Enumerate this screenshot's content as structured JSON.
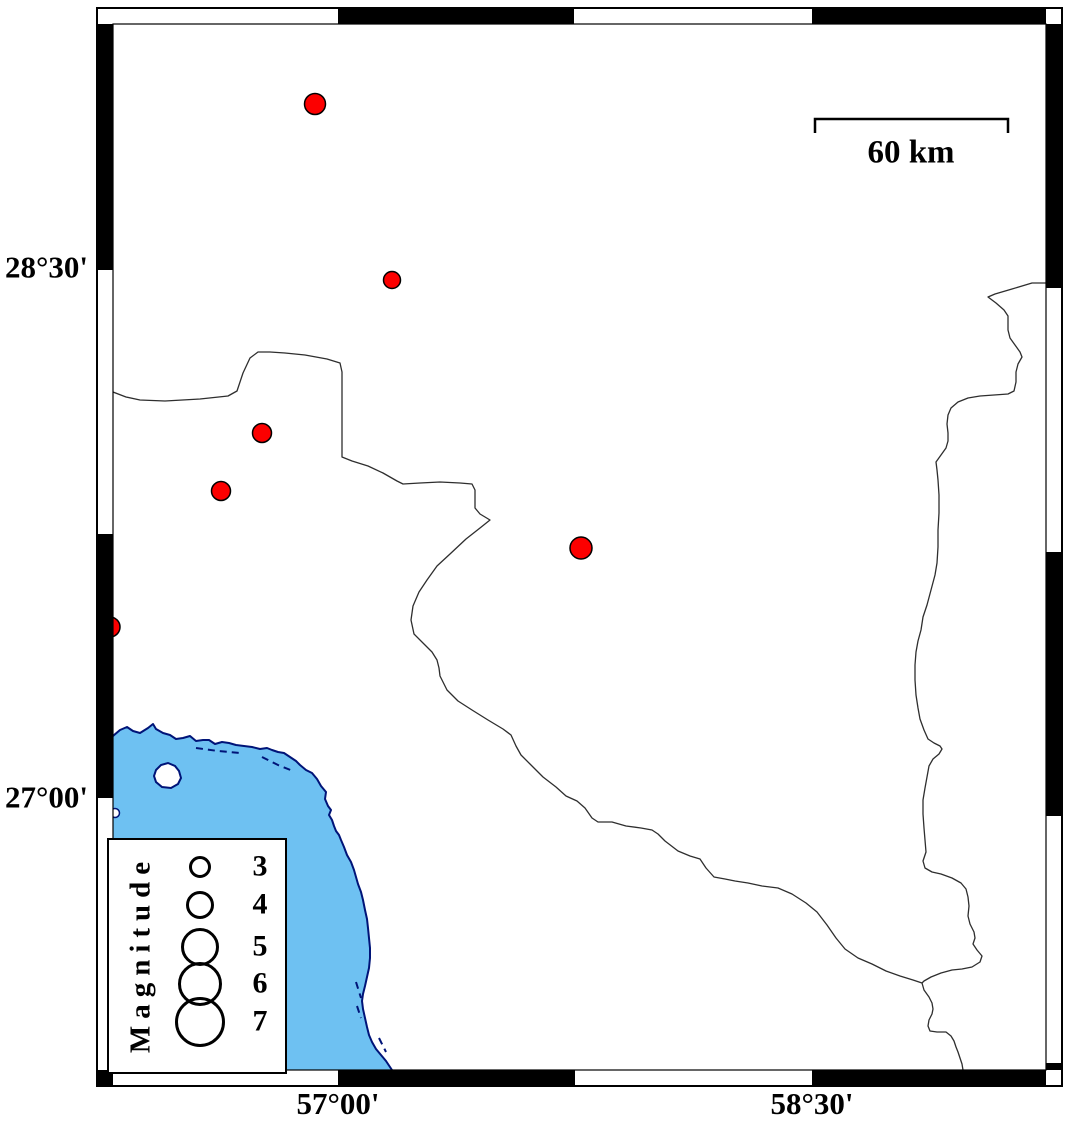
{
  "figure": {
    "width": 1066,
    "height": 1122,
    "background": "#ffffff"
  },
  "colors": {
    "sea": "#6ec1f2",
    "coast": "#001478",
    "epicenter_fill": "#fc0000",
    "epicenter_stroke": "#000000",
    "admin_border": "#2e2e2e",
    "frame_black": "#000000",
    "frame_white": "#ffffff",
    "text": "#000000"
  },
  "axis_labels": {
    "left": [
      {
        "text": "28°30'",
        "y": 268
      },
      {
        "text": "27°00'",
        "y": 798
      }
    ],
    "bottom": [
      {
        "text": "57°00'",
        "x": 338
      },
      {
        "text": "58°30'",
        "x": 812
      }
    ]
  },
  "scale_bar": {
    "label": "60 km",
    "x1": 815,
    "x2": 1008,
    "y": 119,
    "tick_drop": 14
  },
  "legend": {
    "title": "Magnitude",
    "box": {
      "x": 107,
      "y": 838,
      "width": 180,
      "height": 236
    },
    "circle_cx": 198,
    "label_x": 258,
    "entries": [
      {
        "label": "3",
        "cy": 865,
        "r": 11
      },
      {
        "label": "4",
        "cy": 903,
        "r": 14
      },
      {
        "label": "5",
        "cy": 945,
        "r": 19
      },
      {
        "label": "6",
        "cy": 982,
        "r": 22
      },
      {
        "label": "7",
        "cy": 1020,
        "r": 25
      }
    ]
  },
  "earthquakes": [
    {
      "x": 315,
      "y": 104,
      "r": 10.5
    },
    {
      "x": 392,
      "y": 280,
      "r": 8.5
    },
    {
      "x": 262,
      "y": 433,
      "r": 9.5
    },
    {
      "x": 221,
      "y": 491,
      "r": 9.5
    },
    {
      "x": 581,
      "y": 548,
      "r": 11
    },
    {
      "x": 110,
      "y": 627,
      "r": 10
    }
  ],
  "frame": {
    "outer": {
      "x": 97,
      "y": 8,
      "w": 965,
      "h": 1078
    },
    "inner": {
      "x": 113,
      "y": 24,
      "w": 933,
      "h": 1046
    },
    "top_segments": [
      {
        "from": 113,
        "to": 338,
        "color": "white"
      },
      {
        "from": 338,
        "to": 574,
        "color": "black"
      },
      {
        "from": 574,
        "to": 812,
        "color": "white"
      },
      {
        "from": 812,
        "to": 1046,
        "color": "black"
      }
    ],
    "bottom_segments": [
      {
        "from": 113,
        "to": 338,
        "color": "white"
      },
      {
        "from": 338,
        "to": 575,
        "color": "black"
      },
      {
        "from": 575,
        "to": 812,
        "color": "white"
      },
      {
        "from": 812,
        "to": 1046,
        "color": "black"
      }
    ],
    "left_segments": [
      {
        "from": 24,
        "to": 270,
        "color": "black"
      },
      {
        "from": 270,
        "to": 534,
        "color": "white"
      },
      {
        "from": 534,
        "to": 798,
        "color": "black"
      },
      {
        "from": 798,
        "to": 1070,
        "color": "white"
      }
    ],
    "right_segments": [
      {
        "from": 24,
        "to": 288,
        "color": "black"
      },
      {
        "from": 288,
        "to": 552,
        "color": "white"
      },
      {
        "from": 552,
        "to": 816,
        "color": "black"
      },
      {
        "from": 816,
        "to": 1063,
        "color": "white"
      },
      {
        "from": 1063,
        "to": 1070,
        "color": "black"
      }
    ],
    "corners": {
      "tl": "white",
      "tr": "white",
      "bl": "black",
      "br": "white"
    }
  },
  "geography": {
    "coastline": [
      [
        113,
        736
      ],
      [
        120,
        730
      ],
      [
        127,
        727
      ],
      [
        133,
        731
      ],
      [
        140,
        733
      ],
      [
        148,
        728
      ],
      [
        153,
        724
      ],
      [
        156,
        729
      ],
      [
        163,
        733
      ],
      [
        170,
        735
      ],
      [
        176,
        739
      ],
      [
        183,
        738
      ],
      [
        190,
        736
      ],
      [
        196,
        741
      ],
      [
        203,
        740
      ],
      [
        209,
        740
      ],
      [
        215,
        744
      ],
      [
        222,
        742
      ],
      [
        229,
        743
      ],
      [
        236,
        745
      ],
      [
        244,
        746
      ],
      [
        252,
        747
      ],
      [
        260,
        749
      ],
      [
        267,
        748
      ],
      [
        272,
        750
      ],
      [
        278,
        752
      ],
      [
        284,
        753
      ],
      [
        290,
        757
      ],
      [
        296,
        761
      ],
      [
        300,
        765
      ],
      [
        306,
        770
      ],
      [
        312,
        773
      ],
      [
        317,
        779
      ],
      [
        321,
        786
      ],
      [
        326,
        792
      ],
      [
        325,
        799
      ],
      [
        328,
        806
      ],
      [
        331,
        810
      ],
      [
        329,
        815
      ],
      [
        332,
        820
      ],
      [
        334,
        826
      ],
      [
        336,
        831
      ],
      [
        339,
        835
      ],
      [
        341,
        840
      ],
      [
        344,
        847
      ],
      [
        347,
        855
      ],
      [
        351,
        862
      ],
      [
        354,
        870
      ],
      [
        356,
        877
      ],
      [
        358,
        884
      ],
      [
        361,
        892
      ],
      [
        363,
        900
      ],
      [
        365,
        910
      ],
      [
        367,
        919
      ],
      [
        368,
        928
      ],
      [
        369,
        938
      ],
      [
        370,
        948
      ],
      [
        370,
        958
      ],
      [
        369,
        968
      ],
      [
        367,
        977
      ],
      [
        365,
        986
      ],
      [
        363,
        994
      ],
      [
        362,
        1001
      ],
      [
        363,
        1009
      ],
      [
        365,
        1018
      ],
      [
        367,
        1027
      ],
      [
        369,
        1035
      ],
      [
        372,
        1042
      ],
      [
        376,
        1049
      ],
      [
        381,
        1055
      ],
      [
        386,
        1061
      ],
      [
        390,
        1067
      ],
      [
        392,
        1070
      ]
    ],
    "sea_close": [
      [
        392,
        1070
      ],
      [
        113,
        1070
      ]
    ],
    "island": [
      [
        156,
        770
      ],
      [
        161,
        765
      ],
      [
        168,
        763
      ],
      [
        175,
        766
      ],
      [
        179,
        771
      ],
      [
        181,
        778
      ],
      [
        178,
        784
      ],
      [
        171,
        788
      ],
      [
        162,
        787
      ],
      [
        156,
        782
      ],
      [
        154,
        776
      ]
    ],
    "islet": {
      "cx": 115,
      "cy": 813,
      "r": 4.5
    },
    "shoal_dashes": [
      [
        [
          196,
          748
        ],
        [
          218,
          751
        ],
        [
          240,
          753
        ]
      ],
      [
        [
          262,
          757
        ],
        [
          278,
          765
        ],
        [
          293,
          771
        ]
      ],
      [
        [
          356,
          982
        ],
        [
          361,
          998
        ]
      ],
      [
        [
          357,
          1006
        ],
        [
          361,
          1018
        ]
      ],
      [
        [
          379,
          1038
        ],
        [
          386,
          1052
        ]
      ]
    ],
    "admin_borders": [
      [
        [
          113,
          392
        ],
        [
          126,
          397
        ],
        [
          140,
          400
        ],
        [
          165,
          401
        ],
        [
          200,
          399
        ],
        [
          228,
          396
        ],
        [
          237,
          391
        ],
        [
          243,
          373
        ],
        [
          250,
          358
        ],
        [
          258,
          352
        ],
        [
          270,
          352
        ],
        [
          285,
          353
        ],
        [
          305,
          355
        ],
        [
          327,
          359
        ],
        [
          340,
          363
        ],
        [
          342,
          372
        ],
        [
          342,
          457
        ],
        [
          352,
          461
        ],
        [
          368,
          466
        ],
        [
          383,
          473
        ],
        [
          397,
          481
        ],
        [
          403,
          484
        ],
        [
          420,
          483
        ],
        [
          440,
          482
        ],
        [
          460,
          483
        ],
        [
          472,
          484
        ],
        [
          475,
          490
        ],
        [
          475,
          508
        ],
        [
          480,
          514
        ],
        [
          490,
          520
        ],
        [
          480,
          528
        ],
        [
          466,
          539
        ],
        [
          450,
          554
        ],
        [
          437,
          566
        ],
        [
          427,
          580
        ],
        [
          419,
          592
        ],
        [
          413,
          606
        ],
        [
          411,
          620
        ],
        [
          414,
          634
        ],
        [
          425,
          645
        ],
        [
          432,
          652
        ],
        [
          437,
          660
        ],
        [
          439,
          668
        ],
        [
          440,
          676
        ],
        [
          447,
          690
        ],
        [
          458,
          701
        ],
        [
          472,
          710
        ],
        [
          488,
          720
        ],
        [
          503,
          729
        ],
        [
          511,
          735
        ],
        [
          516,
          746
        ],
        [
          521,
          755
        ],
        [
          530,
          764
        ],
        [
          543,
          777
        ],
        [
          556,
          787
        ],
        [
          566,
          796
        ],
        [
          577,
          801
        ],
        [
          585,
          808
        ],
        [
          592,
          818
        ],
        [
          598,
          822
        ],
        [
          612,
          822
        ],
        [
          626,
          826
        ],
        [
          641,
          828
        ],
        [
          652,
          830
        ],
        [
          658,
          834
        ],
        [
          665,
          841
        ],
        [
          678,
          851
        ],
        [
          690,
          856
        ],
        [
          700,
          859
        ],
        [
          706,
          868
        ],
        [
          714,
          877
        ],
        [
          725,
          879
        ],
        [
          735,
          881
        ],
        [
          748,
          883
        ],
        [
          762,
          886
        ],
        [
          778,
          888
        ],
        [
          792,
          894
        ],
        [
          806,
          903
        ],
        [
          817,
          912
        ],
        [
          827,
          925
        ],
        [
          836,
          938
        ],
        [
          845,
          949
        ],
        [
          858,
          958
        ],
        [
          872,
          964
        ],
        [
          886,
          971
        ],
        [
          900,
          976
        ],
        [
          913,
          980
        ],
        [
          922,
          983
        ]
      ],
      [
        [
          1046,
          283
        ],
        [
          1032,
          283
        ],
        [
          1012,
          289
        ],
        [
          995,
          294
        ],
        [
          988,
          297
        ],
        [
          996,
          303
        ],
        [
          1004,
          310
        ],
        [
          1008,
          316
        ],
        [
          1008,
          330
        ],
        [
          1010,
          338
        ],
        [
          1015,
          345
        ],
        [
          1020,
          352
        ],
        [
          1022,
          357
        ],
        [
          1018,
          364
        ],
        [
          1016,
          372
        ],
        [
          1016,
          382
        ],
        [
          1014,
          391
        ],
        [
          1008,
          394
        ],
        [
          994,
          395
        ],
        [
          980,
          396
        ],
        [
          968,
          398
        ],
        [
          958,
          402
        ],
        [
          951,
          408
        ],
        [
          948,
          415
        ],
        [
          947,
          424
        ],
        [
          948,
          433
        ],
        [
          948,
          441
        ],
        [
          946,
          448
        ],
        [
          941,
          455
        ],
        [
          936,
          462
        ],
        [
          937,
          470
        ],
        [
          938,
          480
        ],
        [
          939,
          495
        ],
        [
          939,
          513
        ],
        [
          938,
          530
        ],
        [
          938,
          547
        ],
        [
          937,
          563
        ],
        [
          935,
          575
        ],
        [
          931,
          590
        ],
        [
          927,
          605
        ],
        [
          923,
          617
        ],
        [
          921,
          630
        ],
        [
          918,
          641
        ],
        [
          916,
          652
        ],
        [
          915,
          665
        ],
        [
          915,
          680
        ],
        [
          916,
          695
        ],
        [
          918,
          708
        ],
        [
          920,
          719
        ],
        [
          924,
          730
        ],
        [
          928,
          739
        ],
        [
          934,
          743
        ],
        [
          940,
          746
        ],
        [
          942,
          749
        ],
        [
          939,
          754
        ],
        [
          933,
          759
        ],
        [
          929,
          766
        ],
        [
          927,
          777
        ],
        [
          925,
          788
        ],
        [
          923,
          800
        ],
        [
          923,
          814
        ],
        [
          924,
          828
        ],
        [
          925,
          840
        ],
        [
          926,
          852
        ],
        [
          923,
          861
        ],
        [
          925,
          868
        ],
        [
          932,
          872
        ],
        [
          941,
          874
        ],
        [
          952,
          878
        ],
        [
          961,
          883
        ],
        [
          966,
          889
        ],
        [
          968,
          897
        ],
        [
          969,
          906
        ],
        [
          968,
          916
        ],
        [
          970,
          924
        ],
        [
          974,
          932
        ],
        [
          975,
          938
        ],
        [
          973,
          944
        ],
        [
          977,
          950
        ],
        [
          982,
          956
        ],
        [
          980,
          962
        ],
        [
          972,
          967
        ],
        [
          962,
          969
        ],
        [
          952,
          970
        ],
        [
          941,
          973
        ],
        [
          931,
          977
        ],
        [
          924,
          981
        ],
        [
          922,
          983
        ]
      ],
      [
        [
          922,
          983
        ],
        [
          924,
          990
        ],
        [
          929,
          997
        ],
        [
          932,
          1003
        ],
        [
          933,
          1009
        ],
        [
          932,
          1014
        ],
        [
          929,
          1020
        ],
        [
          928,
          1026
        ],
        [
          930,
          1031
        ],
        [
          937,
          1032
        ],
        [
          946,
          1032
        ],
        [
          951,
          1036
        ],
        [
          954,
          1041
        ],
        [
          956,
          1047
        ],
        [
          958,
          1052
        ],
        [
          960,
          1058
        ],
        [
          962,
          1064
        ],
        [
          963,
          1070
        ]
      ]
    ]
  }
}
